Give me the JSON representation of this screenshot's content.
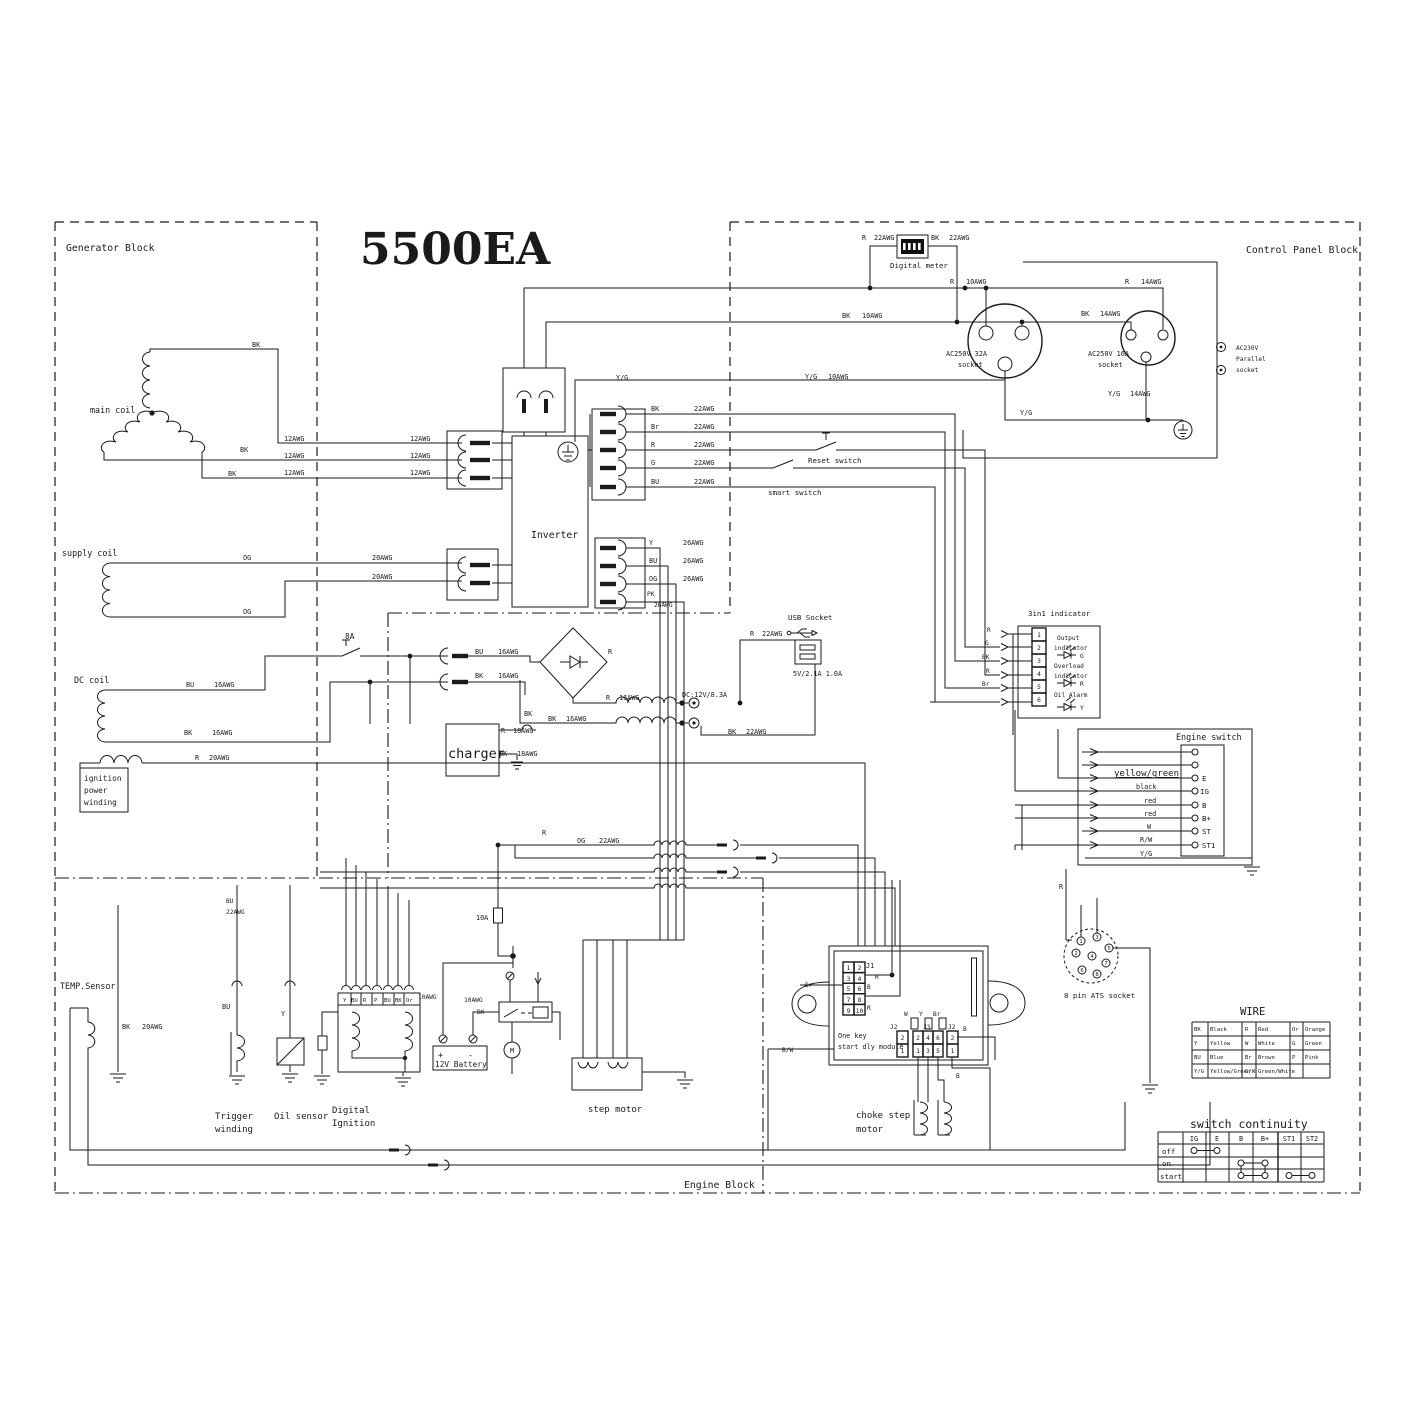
{
  "title": "5500EA",
  "blocks": {
    "generator": "Generator Block",
    "control_panel": "Control Panel Block",
    "engine": "Engine Block"
  },
  "wire": {
    "bk": "BK",
    "bu": "BU",
    "br": "Br",
    "r": "R",
    "g": "G",
    "y": "Y",
    "og": "OG",
    "pk": "PK",
    "or": "Or",
    "w": "W",
    "p": "P",
    "yg": "Y/G",
    "rw": "R/W",
    "bw": "B/W",
    "gw": "G/W"
  },
  "awg": {
    "a10": "10AWG",
    "a12": "12AWG",
    "a14": "14AWG",
    "a16": "16AWG",
    "a18": "18AWG",
    "a20": "20AWG",
    "a22": "22AWG",
    "a26": "26AWG"
  },
  "components": {
    "main_coil": "main coil",
    "supply_coil": "supply coil",
    "dc_coil": "DC coil",
    "ignition_winding": {
      "l1": "ignition",
      "l2": "power",
      "l3": "winding"
    },
    "temp_sensor": "TEMP.Sensor",
    "trigger_winding": {
      "l1": "Trigger",
      "l2": "winding"
    },
    "oil_sensor": "Oil sensor",
    "digital_ignition": {
      "l1": "Digital",
      "l2": "Ignition"
    },
    "battery": "12V Battery",
    "battery_plus": "+",
    "battery_minus": "-",
    "step_motor": "step motor",
    "choke_step_motor": {
      "l1": "choke step",
      "l2": "motor"
    },
    "inverter": "Inverter",
    "charger": "charger",
    "motor_m": "M",
    "digital_meter": "Digital meter",
    "usb_socket": "USB Socket",
    "usb_rating": "5V/2.1A 1.0A",
    "dc_rating": "DC:12V/8.3A",
    "socket_32a": {
      "l1": "AC250V 32A",
      "l2": "socket"
    },
    "socket_16a": {
      "l1": "AC250V 16A",
      "l2": "socket"
    },
    "parallel_socket": {
      "l1": "AC230V",
      "l2": "Parallel",
      "l3": "socket"
    },
    "reset_switch": "Reset switch",
    "smart_switch": "smart switch",
    "fuse_8a": "8A",
    "fuse_10a": "10A",
    "ats_socket": "8 pin ATS socket",
    "one_key_module": {
      "l1": "One key",
      "l2": "start dly module"
    },
    "engine_switch": "Engine switch"
  },
  "di_terminals": [
    "Y",
    "BU",
    "R",
    "P",
    "BU",
    "BK",
    "Or"
  ],
  "indicator": {
    "title": "3in1 indicator",
    "pins": [
      "1",
      "2",
      "3",
      "4",
      "5",
      "6"
    ],
    "pin_wires": [
      "R",
      "G",
      "BK",
      "R",
      "Br"
    ],
    "row1": {
      "l1": "Output",
      "l2": "indicator",
      "led": "G"
    },
    "row2": {
      "l1": "Overload",
      "l2": "indicator",
      "led": "R"
    },
    "row3": {
      "l1": "Oil Alarm",
      "led": "Y"
    }
  },
  "engine_switch": {
    "terminals": [
      "E",
      "IG",
      "B",
      "B+",
      "ST",
      "ST1"
    ],
    "wires": [
      "yellow/green",
      "black",
      "red",
      "red",
      "W",
      "R/W",
      "Y/G"
    ]
  },
  "module": {
    "j1": "J1",
    "j2": "J2",
    "j3": "J3",
    "j1_pins": [
      "1",
      "2",
      "3",
      "4",
      "5",
      "6",
      "7",
      "8",
      "9",
      "10"
    ],
    "j3_top": [
      "2",
      "4",
      "6"
    ],
    "j3_bottom": [
      "1",
      "3",
      "5"
    ],
    "j2_pins": [
      "2",
      "1"
    ],
    "labels": {
      "r": "R",
      "b": "B",
      "br": "Br",
      "bw": "B/W",
      "w": "W",
      "y": "Y"
    }
  },
  "ats_pins": [
    "1",
    "2",
    "3",
    "4",
    "5",
    "6",
    "7",
    "8"
  ],
  "wire_table": {
    "title": "WIRE",
    "rows": [
      [
        "BK",
        "Black",
        "R",
        "Red",
        "Or",
        "Orange"
      ],
      [
        "Y",
        "Yellow",
        "W",
        "White",
        "G",
        "Green"
      ],
      [
        "BU",
        "Blue",
        "Br",
        "Brown",
        "P",
        "Pink"
      ],
      [
        "Y/G",
        "Yellow/Green",
        "G/W",
        "Green/White",
        "",
        ""
      ]
    ]
  },
  "continuity": {
    "title": "switch continuity",
    "columns": [
      "IG",
      "E",
      "B",
      "B+",
      "ST1",
      "ST2"
    ],
    "rows": [
      "off",
      "on",
      "start"
    ]
  }
}
